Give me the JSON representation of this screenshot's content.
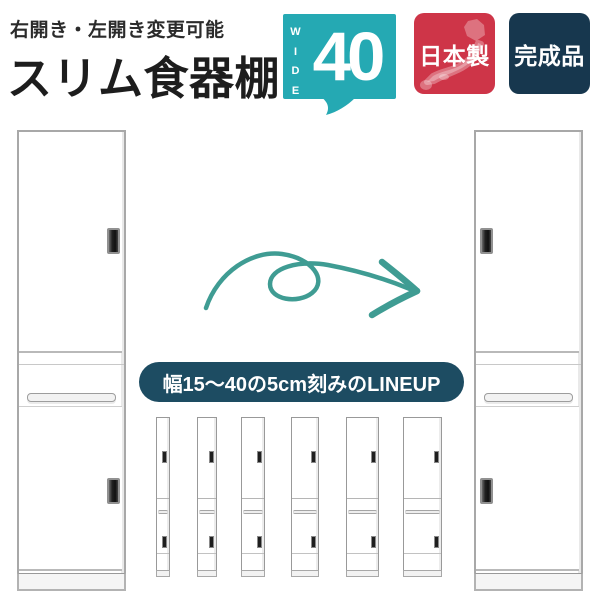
{
  "header": {
    "subtitle": "右開き・左開き変更可能",
    "title": "スリム食器棚",
    "wide_bubble": {
      "vertical_label": "WIDE",
      "value": "40"
    },
    "made_in_japan": {
      "label": "日本製"
    },
    "finished_product": {
      "label": "完成品"
    }
  },
  "banner": {
    "text": "幅15〜40の5cm刻みのLINEUP"
  },
  "lineup": {
    "widths_cm": [
      15,
      20,
      25,
      30,
      35,
      40
    ]
  },
  "icons": {
    "arrow": "swirl-arrow-right",
    "japan_map": "japan-map-silhouette",
    "speech_tail": "speech-bubble-tail"
  },
  "colors": {
    "teal_bubble": "#25a9b3",
    "arrow_teal": "#3f9c93",
    "badge_red": "#ce3548",
    "badge_navy": "#17374e",
    "banner_navy": "#1d4c62",
    "cabinet_outline": "#a8a8a8",
    "title_text": "#1d1d1d"
  }
}
